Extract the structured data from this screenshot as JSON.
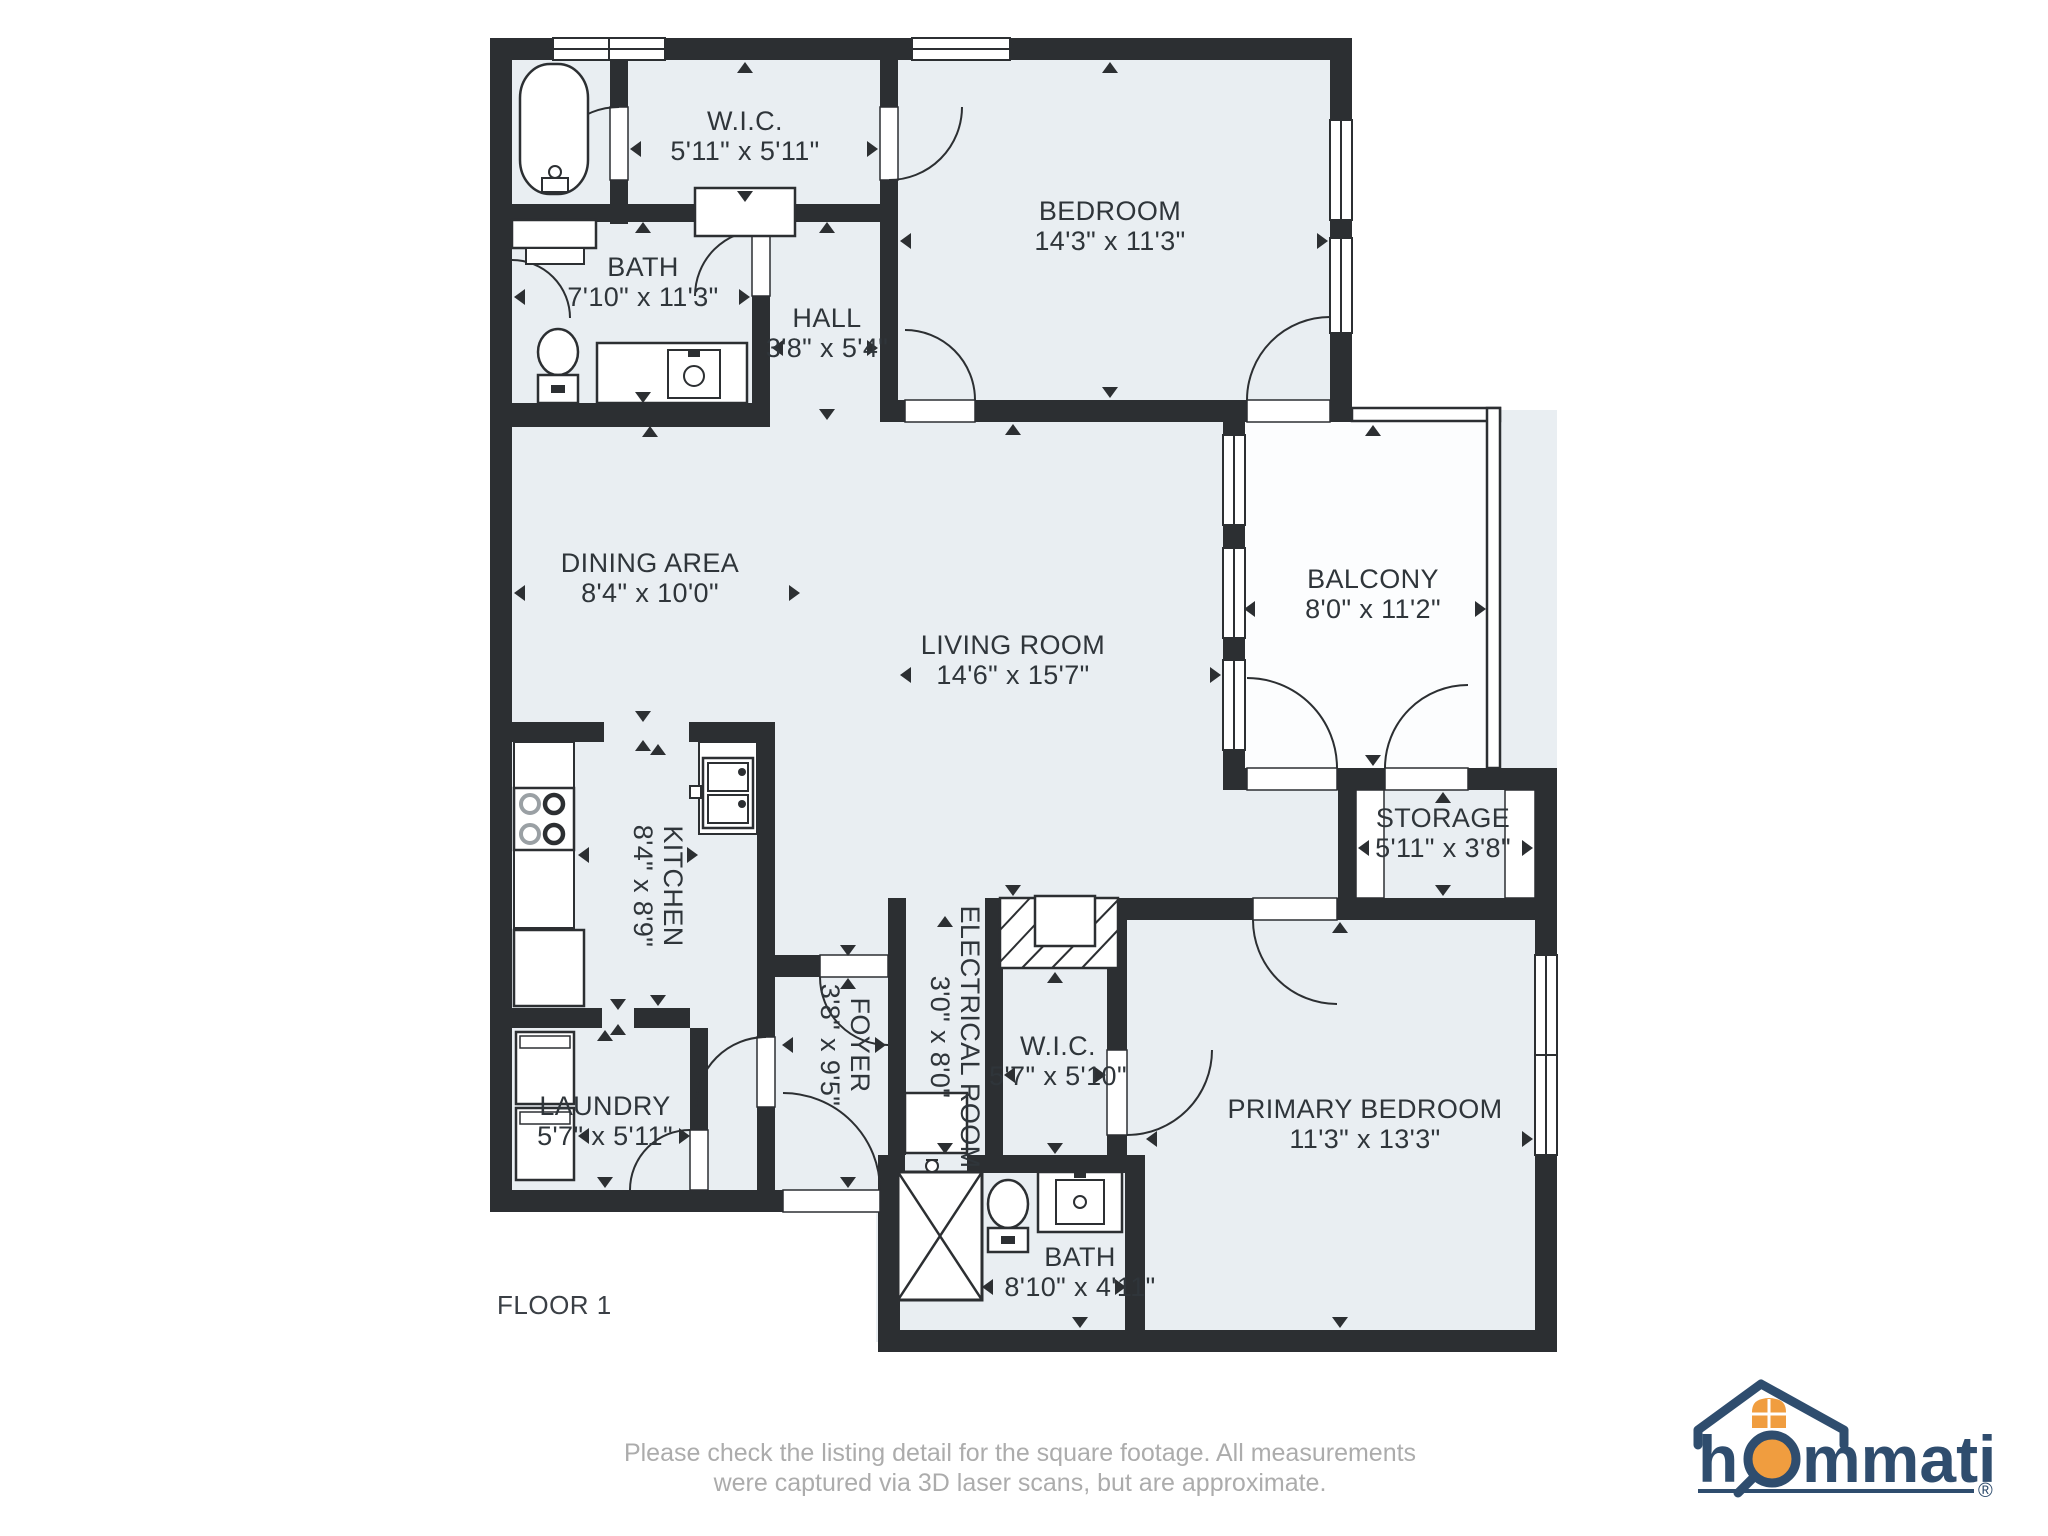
{
  "floor_plan": {
    "floor_label": "FLOOR 1",
    "rooms": [
      {
        "name": "W.I.C.",
        "dims": "5'11\" x 5'11\""
      },
      {
        "name": "BEDROOM",
        "dims": "14'3\" x 11'3\""
      },
      {
        "name": "BATH",
        "dims": "7'10\" x 11'3\""
      },
      {
        "name": "HALL",
        "dims": "3'8\" x 5'4\""
      },
      {
        "name": "DINING AREA",
        "dims": "8'4\" x 10'0\""
      },
      {
        "name": "LIVING ROOM",
        "dims": "14'6\" x 15'7\""
      },
      {
        "name": "BALCONY",
        "dims": "8'0\" x 11'2\""
      },
      {
        "name": "STORAGE",
        "dims": "5'11\" x 3'8\""
      },
      {
        "name": "KITCHEN",
        "dims": "8'4\" x 8'9\""
      },
      {
        "name": "FOYER",
        "dims": "3'8\" x 9'5\""
      },
      {
        "name": "ELECTRICAL ROOM",
        "dims": "3'0\" x 8'0\""
      },
      {
        "name": "W.I.C.",
        "dims": "5'7\" x 5'10\""
      },
      {
        "name": "PRIMARY BEDROOM",
        "dims": "11'3\" x 13'3\""
      },
      {
        "name": "LAUNDRY",
        "dims": "5'7\" x 5'11\""
      },
      {
        "name": "BATH",
        "dims": "8'10\" x 4'11\""
      }
    ]
  },
  "footer": {
    "line1": "Please check the listing detail for the square footage. All measurements",
    "line2": "were captured via 3D laser scans, but are approximate."
  },
  "logo": {
    "text_left": "h",
    "text_right": "mmati",
    "registered": "®"
  },
  "colors": {
    "wall": "#2c2f32",
    "room_fill": "#e9eef2",
    "logo_navy": "#2f4d6e",
    "logo_orange": "#f09d3f",
    "footer_gray": "#acacac"
  }
}
